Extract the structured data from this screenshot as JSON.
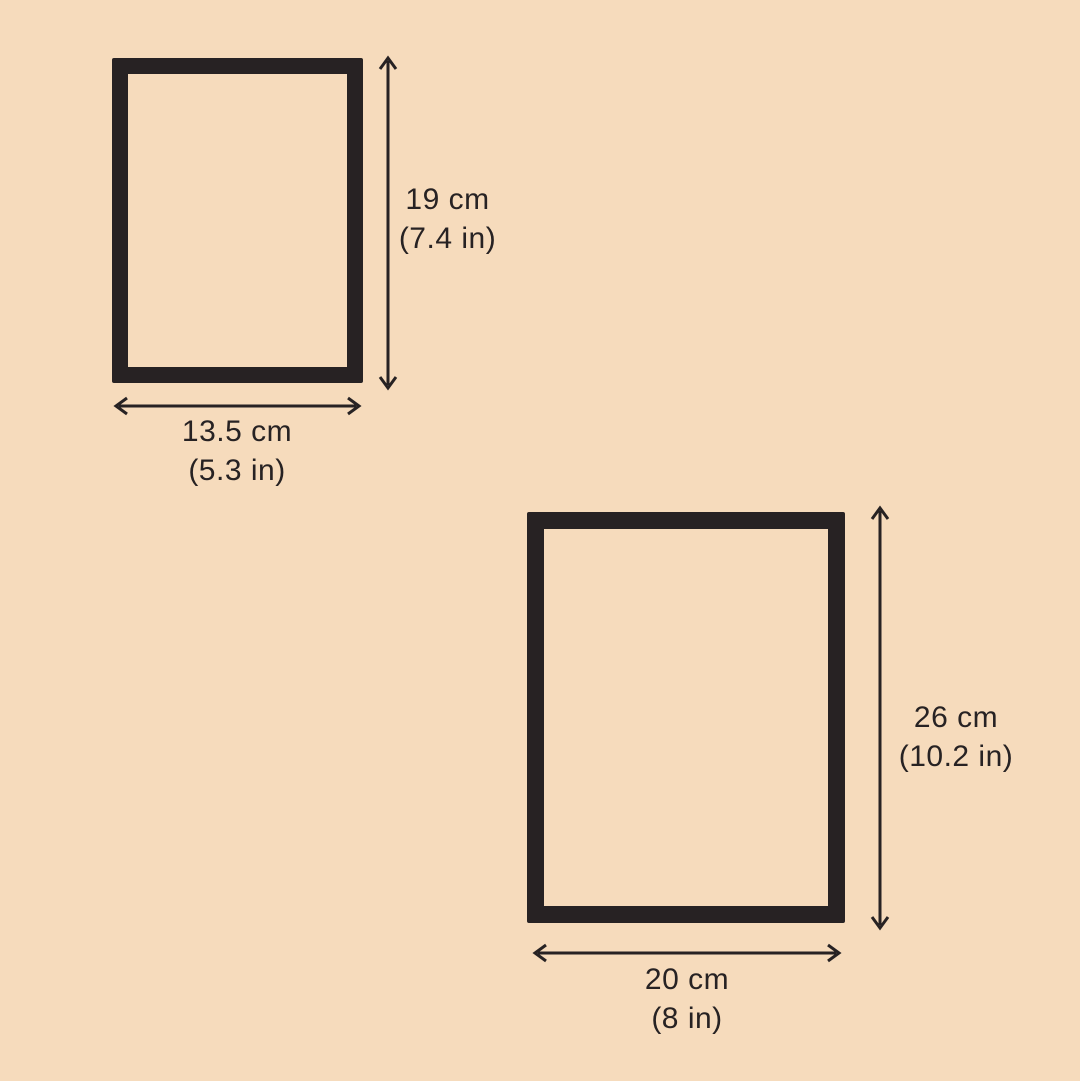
{
  "diagram": {
    "background_color": "#F6DBBC",
    "outline_color": "#272223",
    "figures": [
      {
        "id": "small-rectangle",
        "height": {
          "cm": "19 cm",
          "inches": "(7.4 in)"
        },
        "width": {
          "cm": "13.5 cm",
          "inches": "(5.3 in)"
        }
      },
      {
        "id": "large-rectangle",
        "height": {
          "cm": "26 cm",
          "inches": "(10.2 in)"
        },
        "width": {
          "cm": "20 cm",
          "inches": "(8 in)"
        }
      }
    ]
  }
}
